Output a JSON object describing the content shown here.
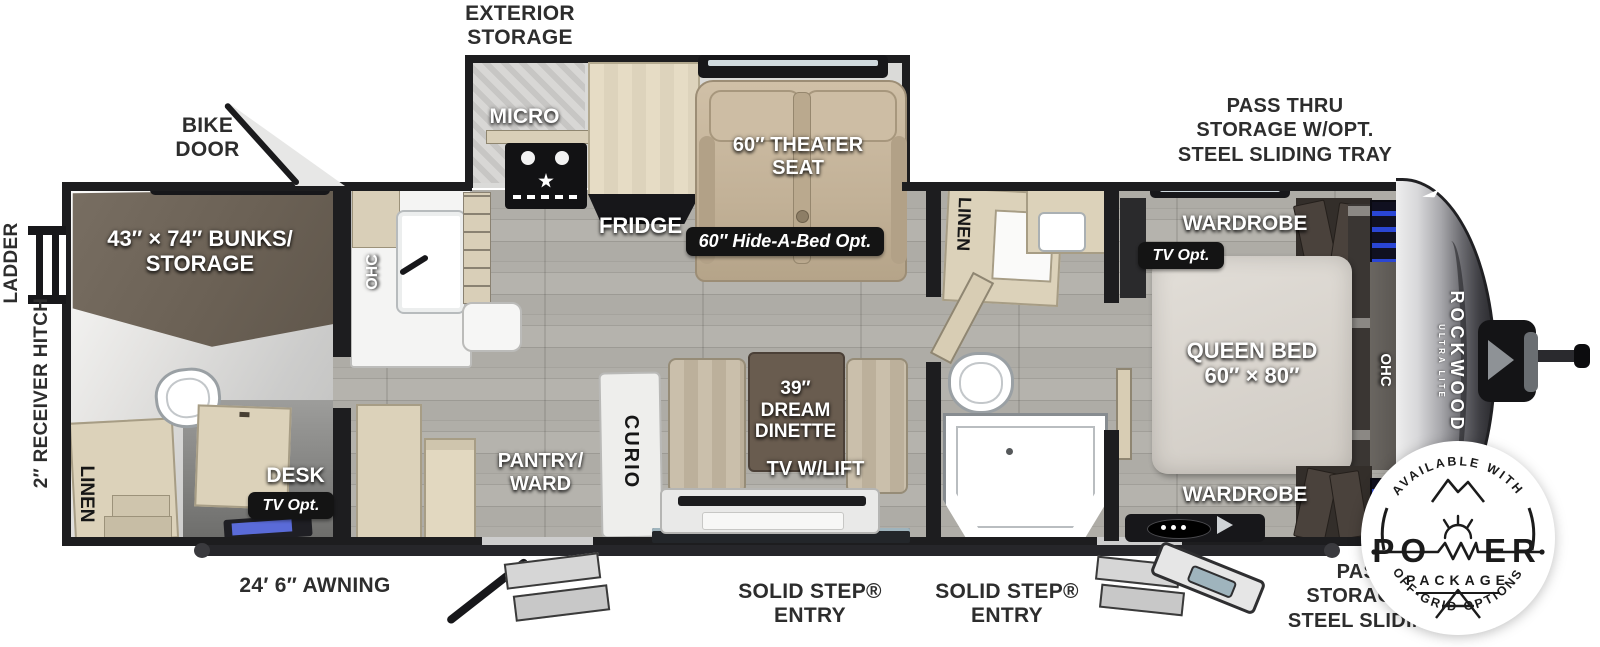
{
  "labels": {
    "exterior_storage": "EXTERIOR\nSTORAGE",
    "bike_door": "BIKE\nDOOR",
    "pass_thru_top": "PASS THRU\nSTORAGE W/OPT.\nSTEEL SLIDING TRAY",
    "pass_thru_bottom": "PASS THRU\nSTORAGE W/OPT.\nSTEEL SLIDING TRAY",
    "awning": "24′ 6″ AWNING",
    "entry_left": "SOLID STEP®\nENTRY",
    "entry_right": "SOLID STEP®\nENTRY",
    "ladder": "LADDER",
    "receiver_hitch": "2″ RECEIVER HITCH"
  },
  "interior": {
    "bunks": "43″ × 74″ BUNKS/\nSTORAGE",
    "ohc_kitchen": "OHC",
    "micro": "MICRO",
    "fridge": "FRIDGE",
    "theater_seat": "60″ THEATER\nSEAT",
    "hide_a_bed": "60″ Hide-A-Bed Opt.",
    "linen_bath": "LINEN",
    "linen_rear": "LINEN",
    "desk": "DESK",
    "tv_opt_rear": "TV Opt.",
    "pantry": "PANTRY/\nWARD",
    "curio": "CURIO",
    "dinette": "39″\nDREAM\nDINETTE",
    "tv_lift": "TV W/LIFT",
    "wardrobe_front_top": "WARDROBE",
    "tv_opt_bedroom": "TV Opt.",
    "queen_bed": "QUEEN BED\n60″ × 80″",
    "ohc_bedroom": "OHC",
    "wardrobe_front_bottom": "WARDROBE"
  },
  "brand": {
    "name": "ROCKWOOD",
    "sub": "ULTRA LITE"
  },
  "badge": {
    "arc_top": "AVAILABLE WITH",
    "power_left": "PO",
    "power_right": "ER",
    "line2": "PACKAGE",
    "arc_bottom": "OFF-GRID OPTIONS"
  },
  "colors": {
    "wall": "#1d1d1f",
    "floor_wood": "#a8a6a0",
    "cabinet_beige": "#dcd2ba",
    "bunk_brown": "#6f6559",
    "seat_tan": "#c7b79d",
    "accent_led_blue": "#2a46d4",
    "badge_ink": "#1b1b1b"
  }
}
